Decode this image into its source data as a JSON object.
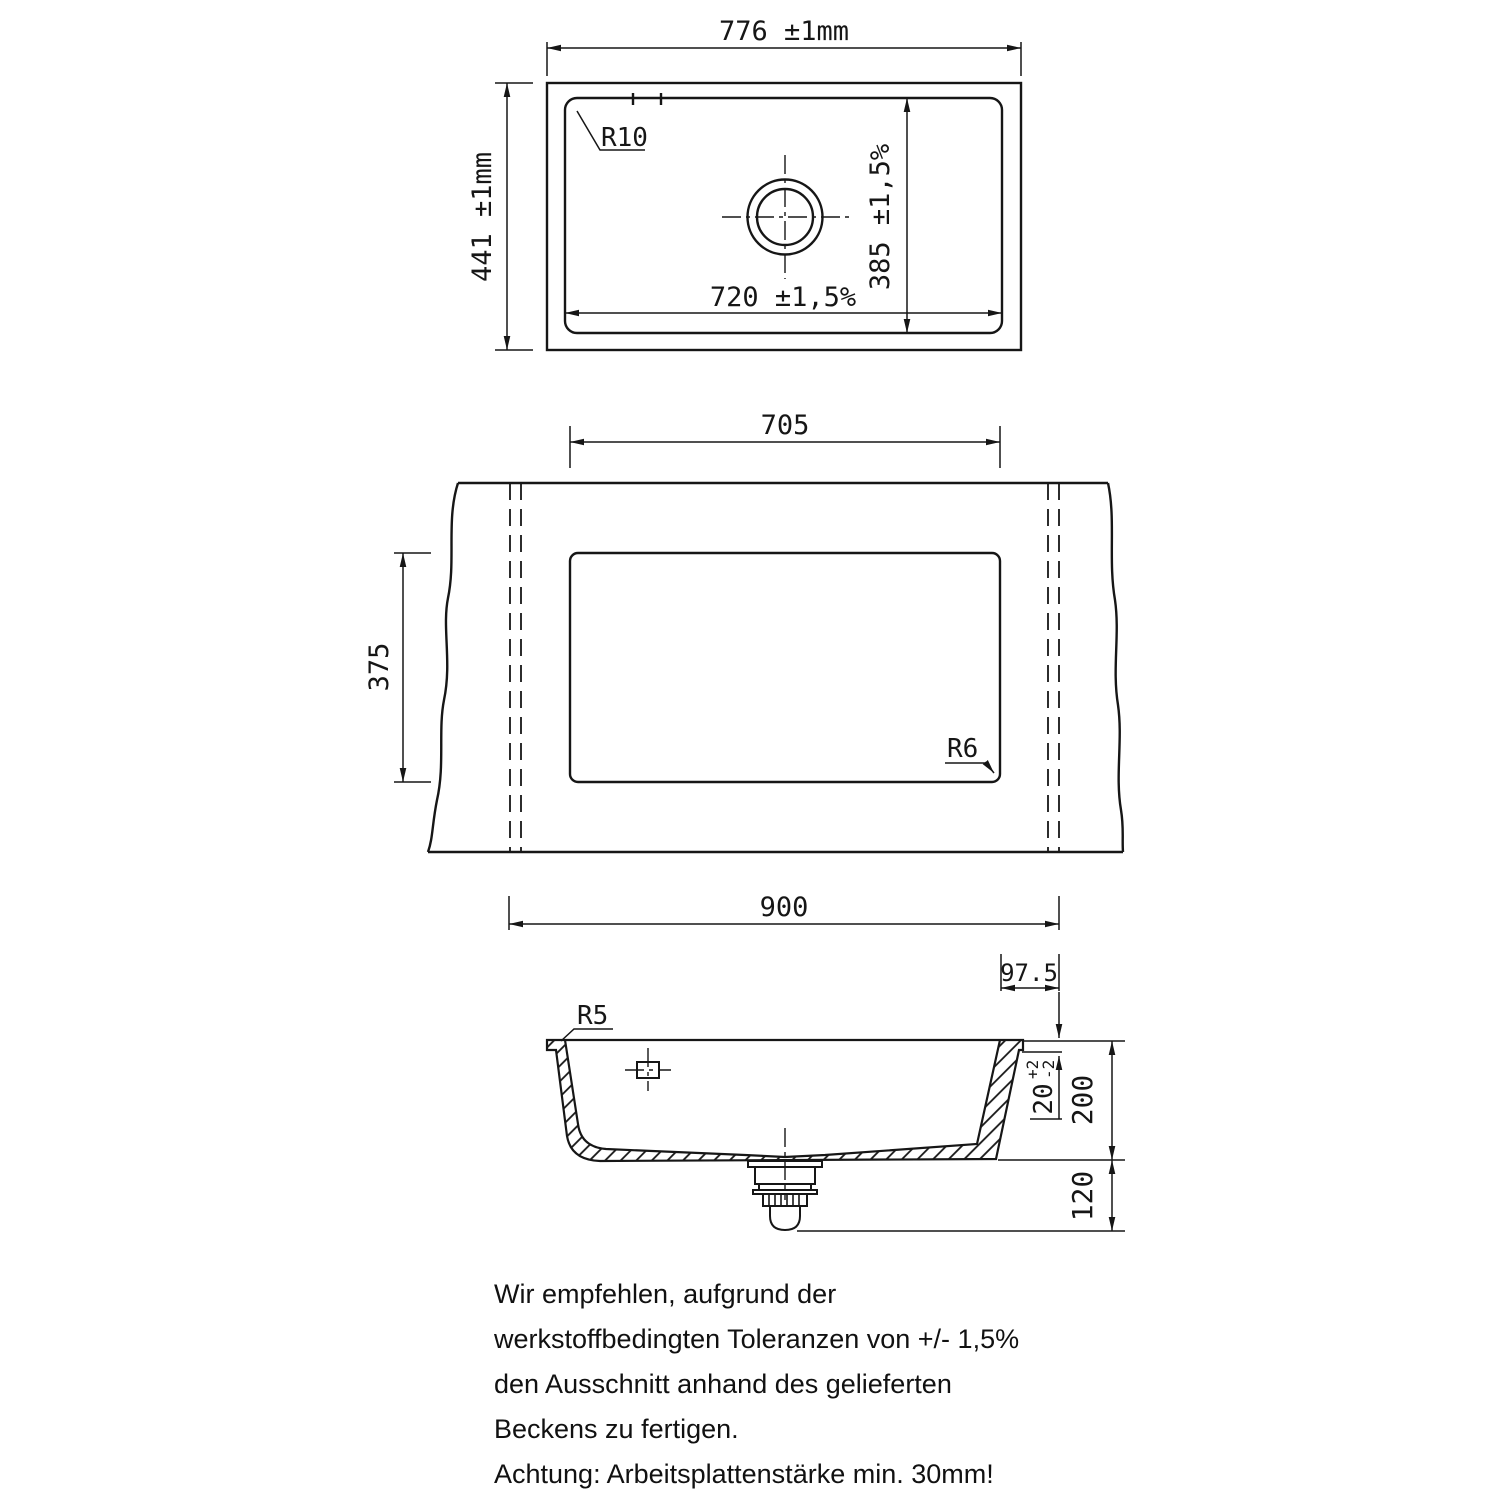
{
  "top_view": {
    "width_dim": "776 ±1mm",
    "height_dim": "441 ±1mm",
    "basin_width_dim": "720 ±1,5%",
    "basin_depth_dim": "385 ±1,5%",
    "corner_radius": "R10"
  },
  "cutout_view": {
    "cutout_width_dim": "705",
    "cutout_height_dim": "375",
    "worktop_width_dim": "900",
    "edge_offset_dim": "97.5",
    "corner_radius": "R6"
  },
  "section_view": {
    "rim_radius": "R5",
    "mounting_step_dim": "20",
    "mounting_step_tol_plus": "+2",
    "mounting_step_tol_minus": "-2",
    "bowl_depth_dim": "200",
    "drain_clearance_dim": "120"
  },
  "notes": {
    "recommendation": [
      "Wir empfehlen, aufgrund der",
      "werkstoffbedingten Toleranzen von +/- 1,5%",
      "den Ausschnitt anhand des gelieferten",
      "Beckens zu fertigen."
    ],
    "warning": "Achtung: Arbeitsplattenstärke min. 30mm!"
  }
}
